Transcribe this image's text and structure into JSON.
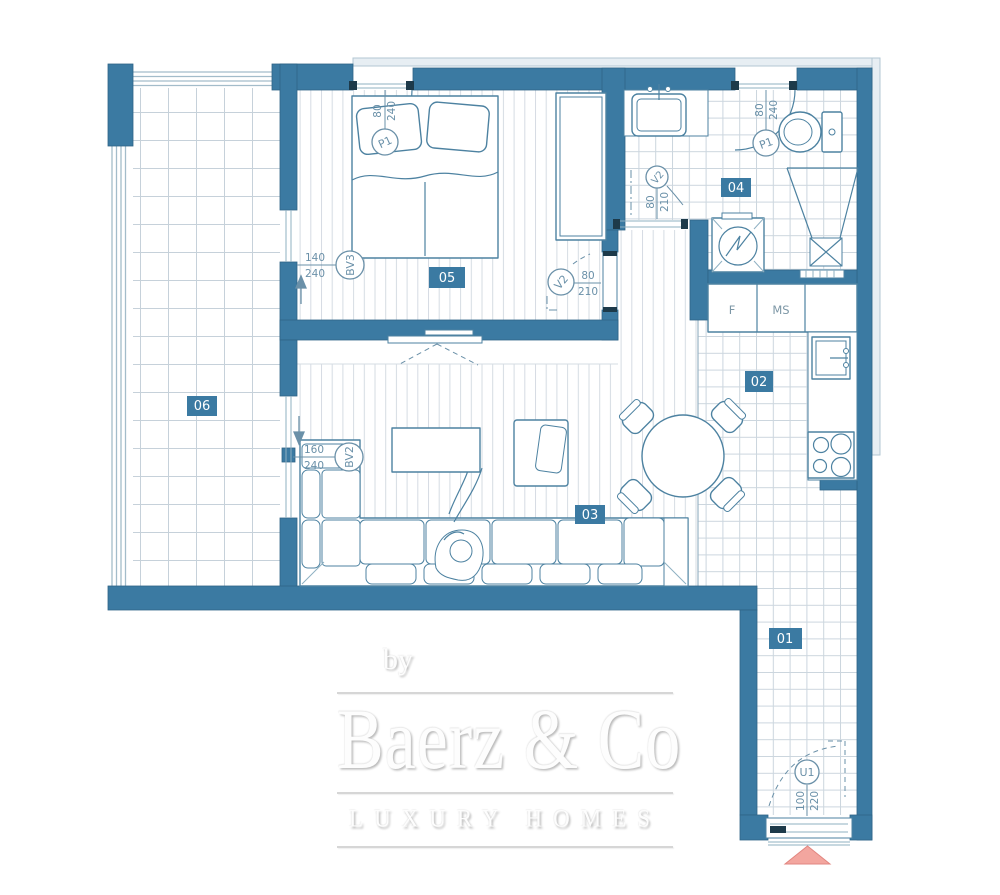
{
  "room_numbers": {
    "hallway": "01",
    "kitchen": "02",
    "living": "03",
    "bathroom": "04",
    "bedroom": "05",
    "terrace": "06"
  },
  "door_labels": {
    "bedroom_door": {
      "code": "P1",
      "w": "80",
      "h": "240"
    },
    "bathroom_door": {
      "code": "P1",
      "w": "80",
      "h": "240"
    },
    "bedroom_sliding": {
      "code": "V2",
      "w": "80",
      "h": "210"
    },
    "bathroom_sliding": {
      "code": "V2",
      "w": "80",
      "h": "210"
    },
    "terrace_bedroom_window": {
      "code": "BV3",
      "w": "140",
      "h": "240"
    },
    "terrace_living_window": {
      "code": "BV2",
      "w": "160",
      "h": "240"
    },
    "entry_door": {
      "code": "U1",
      "w": "100",
      "h": "220"
    }
  },
  "kitchen_labels": {
    "fridge": "F",
    "pantry": "MS"
  },
  "watermark": {
    "by": "by",
    "brand": "Baerz & Co",
    "tagline": "LUXURY HOMES"
  },
  "colors": {
    "wall": "#3b7aa2",
    "outline": "#4d82a1",
    "dimtext": "#6a90a8",
    "lightband": "#e7eef3",
    "entry_marker": "#f3a69f",
    "dark": "#1d3a4a"
  }
}
